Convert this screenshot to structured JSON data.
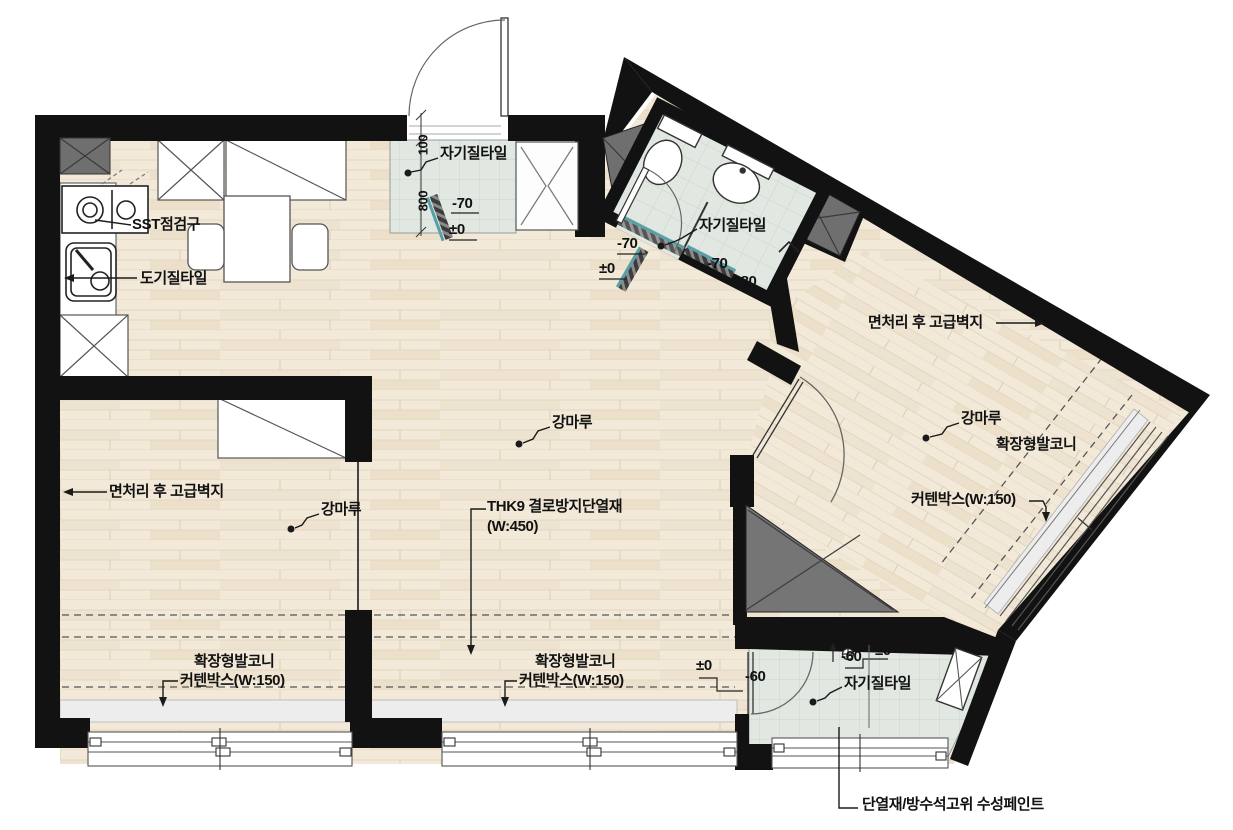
{
  "colors": {
    "wall": "#121212",
    "wood_floor": "#f2e9d9",
    "tile_floor": "#e1e7e1",
    "duct_gray": "#6f6f6f",
    "sill_gray": "#ededed",
    "threshold_teal": "#58a0a8",
    "line_dark": "#1a1a1a"
  },
  "plan": {
    "annotations": [
      {
        "name": "sst-access",
        "text": "SST점검구",
        "x": 132,
        "y": 217
      },
      {
        "name": "ceramic-tile",
        "text": "도기질타일",
        "x": 140,
        "y": 271
      },
      {
        "name": "porcelain-tile-entry",
        "text": "자기질타일",
        "x": 440,
        "y": 146
      },
      {
        "name": "dim-100",
        "text": "100",
        "x": 431,
        "y": 141,
        "rot": -90
      },
      {
        "name": "dim-800",
        "text": "800",
        "x": 431,
        "y": 197,
        "rot": -90
      },
      {
        "name": "level-entry-70",
        "text": "-70",
        "x": 452,
        "y": 196
      },
      {
        "name": "level-entry-0",
        "text": "±0",
        "x": 449,
        "y": 222
      },
      {
        "name": "level-hall-70",
        "text": "-70",
        "x": 617,
        "y": 236
      },
      {
        "name": "level-hall-0",
        "text": "±0",
        "x": 599,
        "y": 261
      },
      {
        "name": "porcelain-tile-bath",
        "text": "자기질타일",
        "x": 699,
        "y": 218
      },
      {
        "name": "level-bath-70",
        "text": "-70",
        "x": 707,
        "y": 256
      },
      {
        "name": "level-bath-80",
        "text": "-80",
        "x": 736,
        "y": 274
      },
      {
        "name": "wallpaper-right",
        "text": "면처리 후 고급벽지",
        "x": 868,
        "y": 315
      },
      {
        "name": "floor-right",
        "text": "강마루",
        "x": 961,
        "y": 411
      },
      {
        "name": "balcony-right",
        "text": "확장형발코니",
        "x": 996,
        "y": 437
      },
      {
        "name": "curtainbox-right",
        "text": "커텐박스(W:150)",
        "x": 911,
        "y": 492
      },
      {
        "name": "floor-living",
        "text": "강마루",
        "x": 552,
        "y": 415
      },
      {
        "name": "insulation-thk9",
        "text": "THK9 결로방지단열재",
        "x": 487,
        "y": 499
      },
      {
        "name": "insulation-thk9-w",
        "text": "(W:450)",
        "x": 487,
        "y": 519
      },
      {
        "name": "wallpaper-left",
        "text": "면처리 후 고급벽지",
        "x": 109,
        "y": 484
      },
      {
        "name": "floor-left",
        "text": "강마루",
        "x": 321,
        "y": 502
      },
      {
        "name": "balcony-left",
        "text": "확장형발코니",
        "x": 194,
        "y": 654
      },
      {
        "name": "curtainbox-left",
        "text": "커텐박스(W:150)",
        "x": 180,
        "y": 673
      },
      {
        "name": "balcony-center",
        "text": "확장형발코니",
        "x": 535,
        "y": 654
      },
      {
        "name": "curtainbox-center",
        "text": "커텐박스(W:150)",
        "x": 519,
        "y": 673
      },
      {
        "name": "level-living-0",
        "text": "±0",
        "x": 696,
        "y": 658
      },
      {
        "name": "level-living-60",
        "text": "-60",
        "x": 745,
        "y": 669
      },
      {
        "name": "level-utility-60",
        "text": "-60",
        "x": 841,
        "y": 649
      },
      {
        "name": "level-utility-0",
        "text": "±0",
        "x": 875,
        "y": 643
      },
      {
        "name": "porcelain-tile-utility",
        "text": "자기질타일",
        "x": 844,
        "y": 676
      },
      {
        "name": "paint-note",
        "text": "단열재/방수석고위 수성페인트",
        "x": 862,
        "y": 797
      },
      {
        "name": "section-marker-a",
        "text": "A",
        "x": 785,
        "y": 246
      }
    ]
  }
}
